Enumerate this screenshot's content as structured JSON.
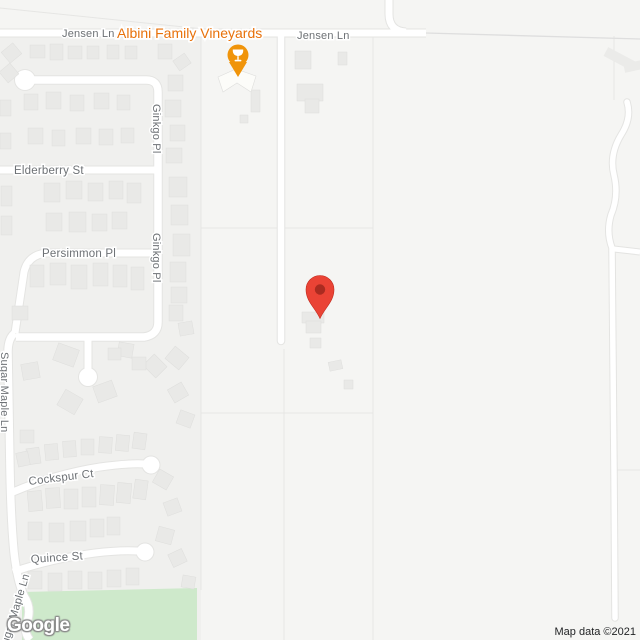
{
  "attribution": {
    "text": "Map data ©2021"
  },
  "watermark": {
    "text": "Google"
  },
  "poi": {
    "name": "Albini Family Vineyards",
    "category": "winery"
  },
  "colors": {
    "base": "#f5f5f3",
    "residential": "#f0f0ee",
    "park": "#cee9cb",
    "road": "#ffffff",
    "road_casing": "#e4e4e2",
    "minor_road": "#dedede",
    "parcel": "#e6e6e4",
    "building": "#e9e9e7",
    "building_stroke": "#dededc",
    "winery_building": "#fcfcf9",
    "deco": "#ebebe9",
    "street_label": "#6d7175",
    "poi_label": "#e8710a",
    "poi_marker": "#f0940a",
    "pin": "#ea4335",
    "pin_stroke": "#c0291c",
    "pin_inner": "#7f1d12"
  },
  "zones": [
    {
      "id": "residential-zone",
      "points": "0,37 201,37 201,640 0,640"
    }
  ],
  "park": {
    "id": "park-area",
    "points": "22,592 197,588 197,640 22,640"
  },
  "parcel_lines": [
    {
      "d": "M0,8 L233,32"
    },
    {
      "d": "M201,37 L201,590"
    },
    {
      "d": "M284,349 L284,640"
    },
    {
      "d": "M373,37 L373,640"
    },
    {
      "d": "M201,228 L373,228"
    },
    {
      "d": "M201,413 L373,413"
    },
    {
      "d": "M614,36 L614,100"
    },
    {
      "d": "M617,470 L640,470"
    }
  ],
  "deco": [
    {
      "x": 604,
      "y": 54,
      "w": 32,
      "h": 10,
      "r": 28
    },
    {
      "x": 624,
      "y": 62,
      "w": 18,
      "h": 9,
      "r": -12
    }
  ],
  "roads": [
    {
      "id": "jensen-ln",
      "d": "M0,33 L426,33",
      "w": 7
    },
    {
      "id": "jensen-ln-north",
      "d": "M389,-4 L389,14 Q389,31 406,32",
      "w": 7
    },
    {
      "id": "ginkgo-loop",
      "d": "M25,80 L146,80 Q158,80 158,92 L158,322 Q158,335 144,337 L16,337",
      "w": 7.5
    },
    {
      "id": "ginkgo-stub",
      "d": "M88,337 L88,372",
      "w": 7
    },
    {
      "id": "elderberry-st",
      "d": "M0,170 L155,170",
      "w": 7
    },
    {
      "id": "persimmon-pl",
      "d": "M155,253 L46,253 Q28,255 24,272 L15,333",
      "w": 7
    },
    {
      "id": "sugar-maple-ln",
      "d": "M15,333 Q8,338 8,352 L10,470 Q11,520 14,552 Q17,580 24,596 Q32,608 27,622 Q23,632 30,640",
      "w": 7.5
    },
    {
      "id": "cockspur-ct",
      "d": "M13,492 Q55,474 100,467 Q128,463 145,464",
      "w": 7
    },
    {
      "id": "quince-st",
      "d": "M13,572 Q50,559 95,553 Q120,550 138,551",
      "w": 7
    },
    {
      "id": "vineyard-driveway",
      "d": "M281,37 L281,341",
      "w": 6.5,
      "cap": "round"
    },
    {
      "id": "right-lane",
      "d": "M627,102 Q632,118 621,135 Q609,155 614,175 Q619,196 611,215 Q606,232 612,248 L613,360 L614,470 L615,618",
      "w": 5.5,
      "cap": "round"
    },
    {
      "id": "right-branch",
      "d": "M614,249 L640,252",
      "w": 5
    },
    {
      "id": "jensen-ln-east-minor",
      "d": "M426,33 L640,39",
      "w": 1.3,
      "type": "minor"
    }
  ],
  "bulbs": [
    {
      "cx": 25,
      "cy": 80,
      "r": 10
    },
    {
      "cx": 88,
      "cy": 377,
      "r": 9
    },
    {
      "cx": 151,
      "cy": 465,
      "r": 8.5
    },
    {
      "cx": 145,
      "cy": 552,
      "r": 8.5
    }
  ],
  "buildings": [
    [
      4,
      46,
      15,
      14,
      -40
    ],
    [
      30,
      45,
      15,
      13,
      0
    ],
    [
      50,
      44,
      13,
      16,
      0
    ],
    [
      68,
      46,
      14,
      13,
      0
    ],
    [
      87,
      46,
      12,
      13,
      0
    ],
    [
      107,
      45,
      12,
      14,
      0
    ],
    [
      125,
      46,
      12,
      13,
      0
    ],
    [
      158,
      44,
      14,
      15,
      0
    ],
    [
      175,
      56,
      14,
      12,
      -35
    ],
    [
      338,
      52,
      9,
      13,
      0
    ],
    [
      2,
      66,
      14,
      14,
      -40
    ],
    [
      0,
      100,
      11,
      16,
      0
    ],
    [
      0,
      133,
      11,
      16,
      0
    ],
    [
      24,
      94,
      14,
      16,
      0
    ],
    [
      46,
      92,
      15,
      17,
      0
    ],
    [
      70,
      95,
      14,
      16,
      0
    ],
    [
      94,
      93,
      15,
      16,
      0
    ],
    [
      117,
      95,
      13,
      15,
      0
    ],
    [
      28,
      128,
      15,
      16,
      0
    ],
    [
      52,
      130,
      13,
      16,
      0
    ],
    [
      76,
      128,
      15,
      16,
      0
    ],
    [
      99,
      129,
      14,
      16,
      0
    ],
    [
      121,
      128,
      13,
      15,
      0
    ],
    [
      168,
      75,
      15,
      16,
      0
    ],
    [
      165,
      100,
      16,
      17,
      0
    ],
    [
      170,
      125,
      15,
      16,
      0
    ],
    [
      166,
      148,
      16,
      15,
      0
    ],
    [
      44,
      183,
      16,
      19,
      0
    ],
    [
      66,
      181,
      16,
      18,
      0
    ],
    [
      88,
      183,
      15,
      18,
      0
    ],
    [
      109,
      181,
      14,
      18,
      0
    ],
    [
      127,
      183,
      14,
      20,
      0
    ],
    [
      1,
      186,
      11,
      20,
      0
    ],
    [
      1,
      216,
      11,
      19,
      0
    ],
    [
      46,
      213,
      16,
      18,
      0
    ],
    [
      69,
      212,
      17,
      20,
      0
    ],
    [
      92,
      214,
      15,
      17,
      0
    ],
    [
      112,
      212,
      15,
      17,
      0
    ],
    [
      169,
      177,
      18,
      20,
      0
    ],
    [
      171,
      205,
      17,
      20,
      0
    ],
    [
      173,
      234,
      17,
      22,
      0
    ],
    [
      170,
      262,
      16,
      20,
      0
    ],
    [
      171,
      287,
      16,
      16,
      0
    ],
    [
      169,
      305,
      14,
      16,
      0
    ],
    [
      179,
      322,
      14,
      13,
      -10
    ],
    [
      30,
      265,
      14,
      22,
      0
    ],
    [
      50,
      263,
      16,
      22,
      0
    ],
    [
      71,
      265,
      16,
      24,
      0
    ],
    [
      93,
      263,
      15,
      23,
      0
    ],
    [
      113,
      265,
      14,
      22,
      0
    ],
    [
      131,
      267,
      13,
      23,
      0
    ],
    [
      12,
      306,
      16,
      14,
      0
    ],
    [
      55,
      346,
      22,
      18,
      20
    ],
    [
      22,
      363,
      17,
      16,
      -10
    ],
    [
      60,
      393,
      20,
      18,
      30
    ],
    [
      95,
      383,
      20,
      17,
      -20
    ],
    [
      118,
      343,
      15,
      14,
      10
    ],
    [
      146,
      358,
      18,
      16,
      45
    ],
    [
      108,
      348,
      13,
      12,
      0
    ],
    [
      20,
      430,
      14,
      13,
      0
    ],
    [
      168,
      350,
      18,
      16,
      40
    ],
    [
      170,
      385,
      16,
      15,
      -30
    ],
    [
      178,
      412,
      15,
      14,
      20
    ],
    [
      132,
      357,
      14,
      13,
      0
    ],
    [
      27,
      448,
      13,
      16,
      -8
    ],
    [
      45,
      444,
      13,
      16,
      -5
    ],
    [
      63,
      441,
      13,
      16,
      -3
    ],
    [
      81,
      439,
      13,
      16,
      0
    ],
    [
      99,
      437,
      13,
      16,
      3
    ],
    [
      116,
      435,
      13,
      16,
      5
    ],
    [
      133,
      433,
      13,
      16,
      8
    ],
    [
      17,
      452,
      12,
      14,
      -12
    ],
    [
      28,
      491,
      14,
      20,
      -5
    ],
    [
      46,
      488,
      14,
      20,
      -3
    ],
    [
      64,
      489,
      14,
      20,
      0
    ],
    [
      82,
      487,
      14,
      20,
      0
    ],
    [
      100,
      485,
      14,
      20,
      3
    ],
    [
      117,
      483,
      14,
      20,
      5
    ],
    [
      134,
      480,
      13,
      19,
      8
    ],
    [
      28,
      522,
      14,
      18,
      0
    ],
    [
      49,
      523,
      15,
      19,
      0
    ],
    [
      70,
      521,
      16,
      20,
      0
    ],
    [
      90,
      519,
      14,
      18,
      0
    ],
    [
      107,
      517,
      13,
      18,
      0
    ],
    [
      28,
      571,
      14,
      18,
      0
    ],
    [
      48,
      573,
      14,
      18,
      0
    ],
    [
      68,
      571,
      14,
      18,
      0
    ],
    [
      88,
      572,
      14,
      17,
      0
    ],
    [
      107,
      570,
      14,
      17,
      0
    ],
    [
      126,
      568,
      13,
      17,
      0
    ],
    [
      155,
      472,
      16,
      15,
      30
    ],
    [
      165,
      500,
      15,
      14,
      -20
    ],
    [
      157,
      528,
      16,
      15,
      15
    ],
    [
      170,
      551,
      15,
      14,
      -25
    ],
    [
      182,
      576,
      13,
      12,
      10
    ],
    [
      251,
      90,
      9,
      22,
      0
    ],
    [
      240,
      115,
      8,
      8,
      0
    ],
    [
      295,
      51,
      16,
      18,
      0
    ],
    [
      297,
      84,
      26,
      17,
      0
    ],
    [
      305,
      99,
      14,
      14,
      0
    ],
    [
      302,
      312,
      22,
      11,
      0
    ],
    [
      306,
      321,
      15,
      12,
      0
    ],
    [
      310,
      338,
      11,
      10,
      0
    ],
    [
      329,
      361,
      13,
      9,
      -12
    ],
    [
      344,
      380,
      9,
      9,
      0
    ]
  ],
  "winery_building": {
    "points": "218,77 236,69 256,76 251,92 237,83 223,92"
  },
  "labels": [
    {
      "id": "jensen-ln-west",
      "text": "Jensen Ln",
      "x": 62,
      "y": 37,
      "size": 11
    },
    {
      "id": "albini-family-vineyards",
      "text": "Albini Family Vineyards",
      "x": 117,
      "y": 38,
      "size": 14,
      "type": "poi"
    },
    {
      "id": "jensen-ln-east",
      "text": "Jensen Ln",
      "x": 297,
      "y": 39,
      "size": 11
    },
    {
      "id": "ginkgo-pl-north",
      "text": "Ginkgo Pl",
      "x": 0,
      "y": 0,
      "size": 11,
      "transform": "translate(153,104) rotate(90)"
    },
    {
      "id": "elderberry-st",
      "text": "Elderberry St",
      "x": 14,
      "y": 174,
      "size": 11.5
    },
    {
      "id": "ginkgo-pl-south",
      "text": "Ginkgo Pl",
      "x": 0,
      "y": 0,
      "size": 11,
      "transform": "translate(153,233) rotate(90)"
    },
    {
      "id": "persimmon-pl",
      "text": "Persimmon Pl",
      "x": 42,
      "y": 257,
      "size": 11.5
    },
    {
      "id": "sugar-maple-ln",
      "text": "Sugar Maple Ln",
      "x": 0,
      "y": 0,
      "size": 11,
      "transform": "translate(1,352) rotate(90)"
    },
    {
      "id": "cockspur-ct",
      "text": "Cockspur Ct",
      "x": 29,
      "y": 485,
      "size": 11.5,
      "transform": "rotate(-7 29 485)"
    },
    {
      "id": "quince-st",
      "text": "Quince St",
      "x": 31,
      "y": 563,
      "size": 11.5,
      "transform": "rotate(-4 31 563)"
    },
    {
      "id": "sugar-maple-ln-south",
      "text": "Sugar Maple Ln",
      "x": 0,
      "y": 0,
      "size": 11,
      "transform": "translate(6,652) rotate(-73)"
    }
  ],
  "markers": {
    "destination": {
      "x": 320,
      "head_y": 289.5,
      "tip_y": 318.5,
      "r": 14,
      "inner_r": 5.2
    },
    "poi": {
      "x": 238,
      "head_y": 55,
      "tip_y": 77,
      "r": 10.5,
      "icon": "wine-glass-icon"
    }
  }
}
